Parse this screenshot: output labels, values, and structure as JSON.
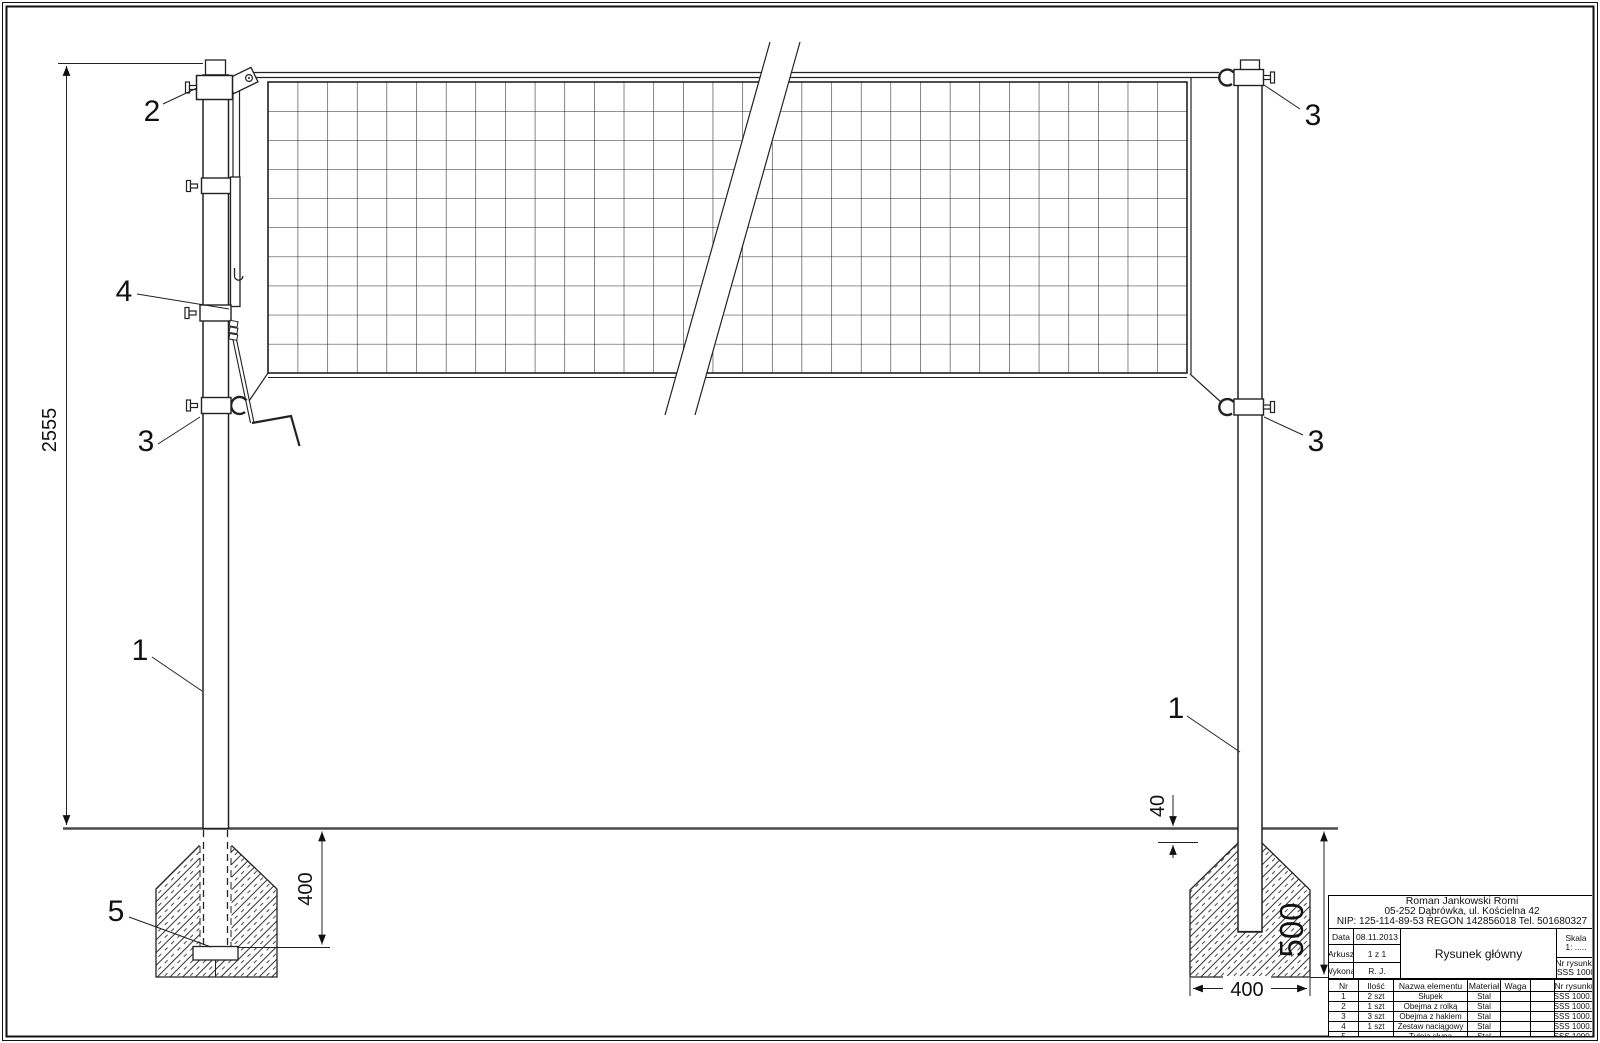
{
  "dimensions": {
    "post_height": "2555",
    "embed_depth": "400",
    "top_offset": "40",
    "foundation_depth": "500",
    "foundation_width": "400"
  },
  "callouts": {
    "c1": "1",
    "c2": "2",
    "c3": "3",
    "c4": "4",
    "c5": "5"
  },
  "title_block": {
    "company": {
      "line1": "Roman Jankowski Romi",
      "line2": "05-252 Dąbrówka, ul. Kościelna 42",
      "line3": "NIP: 125-114-89-53 REGON 142856018 Tel. 501680327"
    },
    "fields": {
      "data_label": "Data",
      "data_value": "08.11.2013",
      "arkusz_label": "Arkusz",
      "arkusz_value": "1 z 1",
      "wykonal_label": "Wykonał",
      "wykonal_value": "R. J.",
      "title": "Rysunek główny",
      "skala_label": "Skala",
      "skala_value": "1: .....",
      "nr_label": "Nr rysunku",
      "nr_value": "SSS 1000"
    },
    "parts_table": {
      "headers": [
        "Nr",
        "Ilość",
        "Nazwa elementu",
        "Materiał",
        "Waga",
        "",
        "Nr rysunku"
      ],
      "rows": [
        [
          "1",
          "2 szt",
          "Słupek",
          "Stal",
          "",
          "",
          "SSS 1000.1"
        ],
        [
          "2",
          "1 szt",
          "Obejma z rolką",
          "Stal",
          "",
          "",
          "SSS 1000.2"
        ],
        [
          "3",
          "3 szt",
          "Obejma z hakiem",
          "Stal",
          "",
          "",
          "SSS 1000.3"
        ],
        [
          "4",
          "1 szt",
          "Zestaw naciągowy",
          "Stal",
          "",
          "",
          "SSS 1000.4"
        ],
        [
          "5",
          "",
          "Tuleja słupa",
          "Stal",
          "",
          "",
          "SSS 1000.5"
        ]
      ]
    }
  }
}
